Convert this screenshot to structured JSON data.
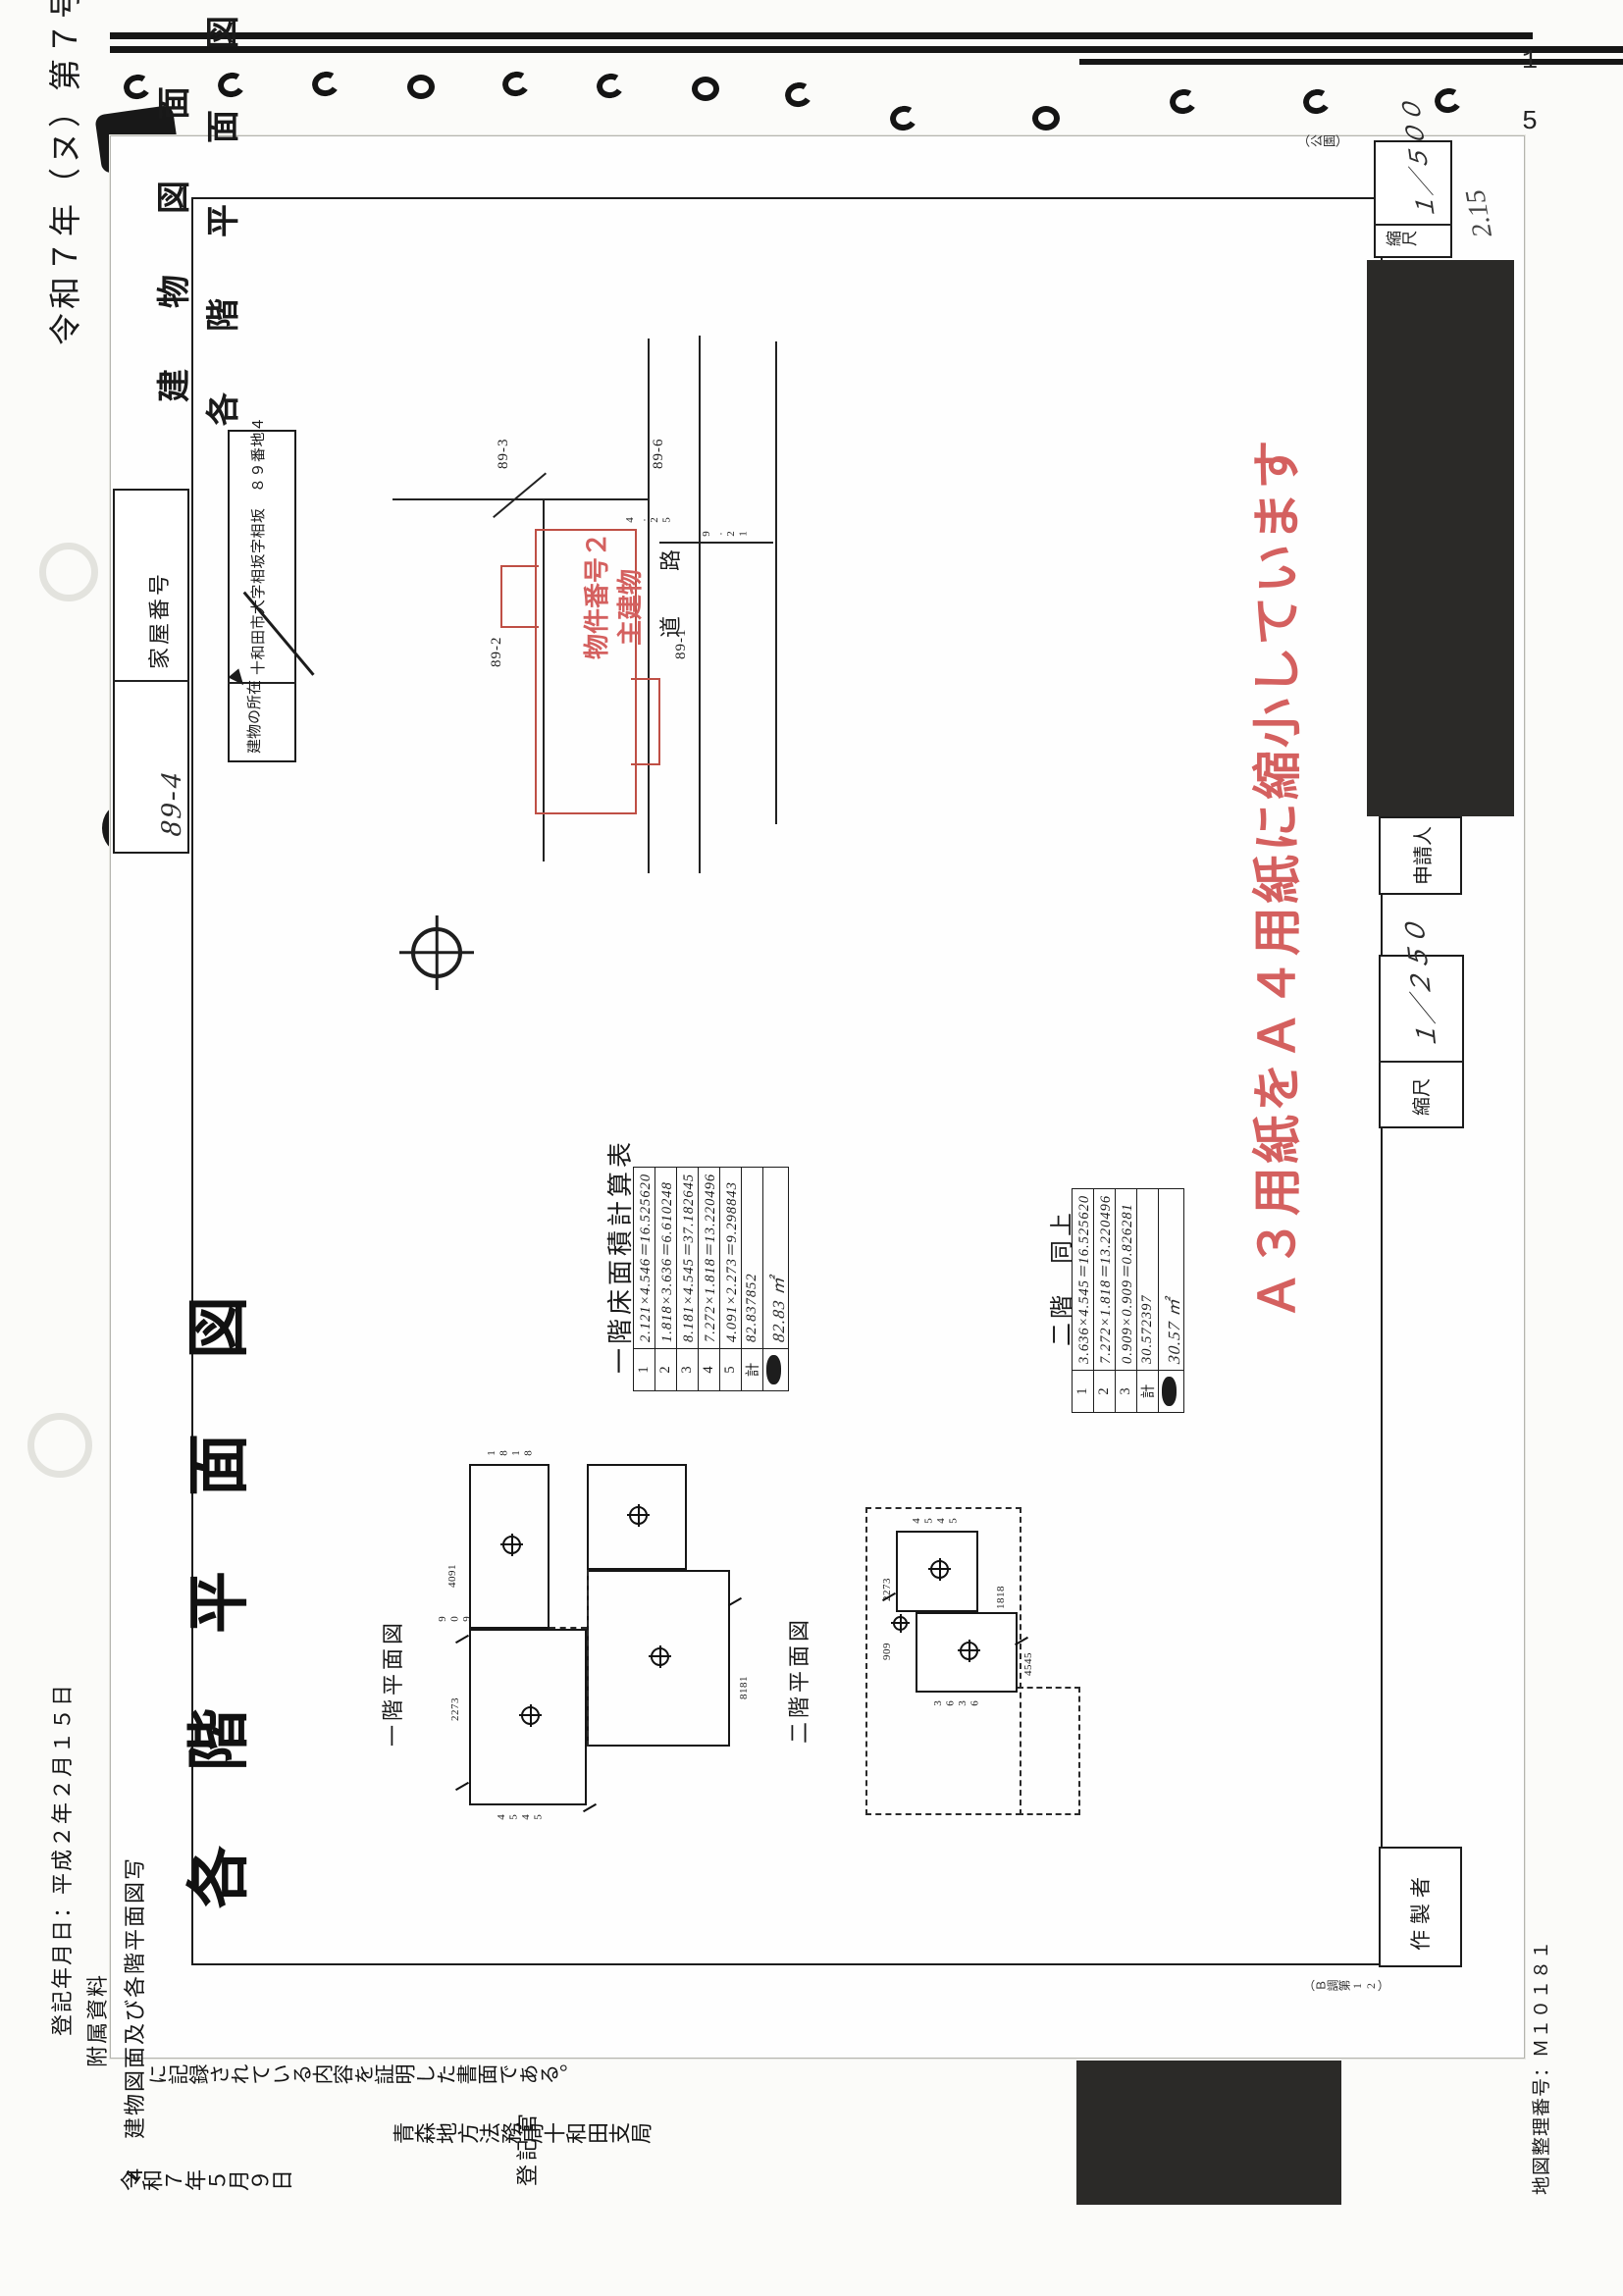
{
  "page": {
    "number": "1 5"
  },
  "case_label": "令和７年（ヌ）第７号",
  "form": {
    "title_line1": "建　物　図　面",
    "title_line2": "各　階　平　面　図",
    "section_heading": "各 階 平 面 図",
    "house_number_label": "家屋番号",
    "house_number_value": "89-4",
    "location_label": "建物の所在",
    "location_value": "十和田市大字相坂字相坂　８９番地４",
    "reduction_note": "Ａ３用紙をＡ４用紙に縮小しています",
    "edge_note": "（公園）",
    "check_note": "2.15",
    "survey_note": "（Ｂ調第12）"
  },
  "margin": {
    "scale_label_right": "縮尺",
    "scale_value_right": "１／５００",
    "scale_label_left": "縮尺",
    "scale_value_left": "１／２５０",
    "applicant_label": "申請人",
    "preparer_label": "作製者"
  },
  "site_plan": {
    "building_label_line1": "物件番号２",
    "building_label_line2": "主建物",
    "road_char1": "道",
    "road_char2": "路",
    "lots": [
      "89-2",
      "89-3",
      "89-6",
      "89-1"
    ],
    "dims": [
      "4.25",
      "9.21"
    ]
  },
  "plans": {
    "first_label": "一階平面図",
    "second_label": "二階平面図",
    "first_dims": [
      "4091",
      "909",
      "2273",
      "8181",
      "1818",
      "4545"
    ],
    "second_dims": [
      "2273",
      "4545",
      "3636",
      "4545",
      "1818",
      "909"
    ]
  },
  "tables": {
    "first": {
      "heading": "一階床面積計算表",
      "rows": [
        {
          "no": "1",
          "calc": "2.121×4.546＝16.525620"
        },
        {
          "no": "2",
          "calc": "1.818×3.636＝6.610248"
        },
        {
          "no": "3",
          "calc": "8.181×4.545＝37.182645"
        },
        {
          "no": "4",
          "calc": "7.272×1.818＝13.220496"
        },
        {
          "no": "5",
          "calc": "4.091×2.273＝9.298843"
        },
        {
          "no": "計",
          "calc": "82.837852"
        },
        {
          "no": "",
          "calc": "82.83 ㎡"
        }
      ]
    },
    "second": {
      "heading": "二階　同上",
      "rows": [
        {
          "no": "1",
          "calc": "3.636×4.545＝16.525620"
        },
        {
          "no": "2",
          "calc": "7.272×1.818＝13.220496"
        },
        {
          "no": "3",
          "calc": "0.909×0.909＝0.826281"
        },
        {
          "no": "計",
          "calc": "30.572397"
        },
        {
          "no": "",
          "calc": "30.57 ㎡"
        }
      ]
    }
  },
  "certificate": {
    "reg_date_line": "登記年月日：平成２年２月１５日",
    "attachment_label": "附属資料",
    "attachment_item": "４　建物図面及び各階平面図写",
    "statement": "に記録されている内容を証明した書面である。",
    "issue_date": "令和７年５月９日",
    "office": "青森地方法務局十和田支局",
    "registrar_label": "登記官",
    "map_number": "地図整理番号：Ｍ１０１８１"
  }
}
